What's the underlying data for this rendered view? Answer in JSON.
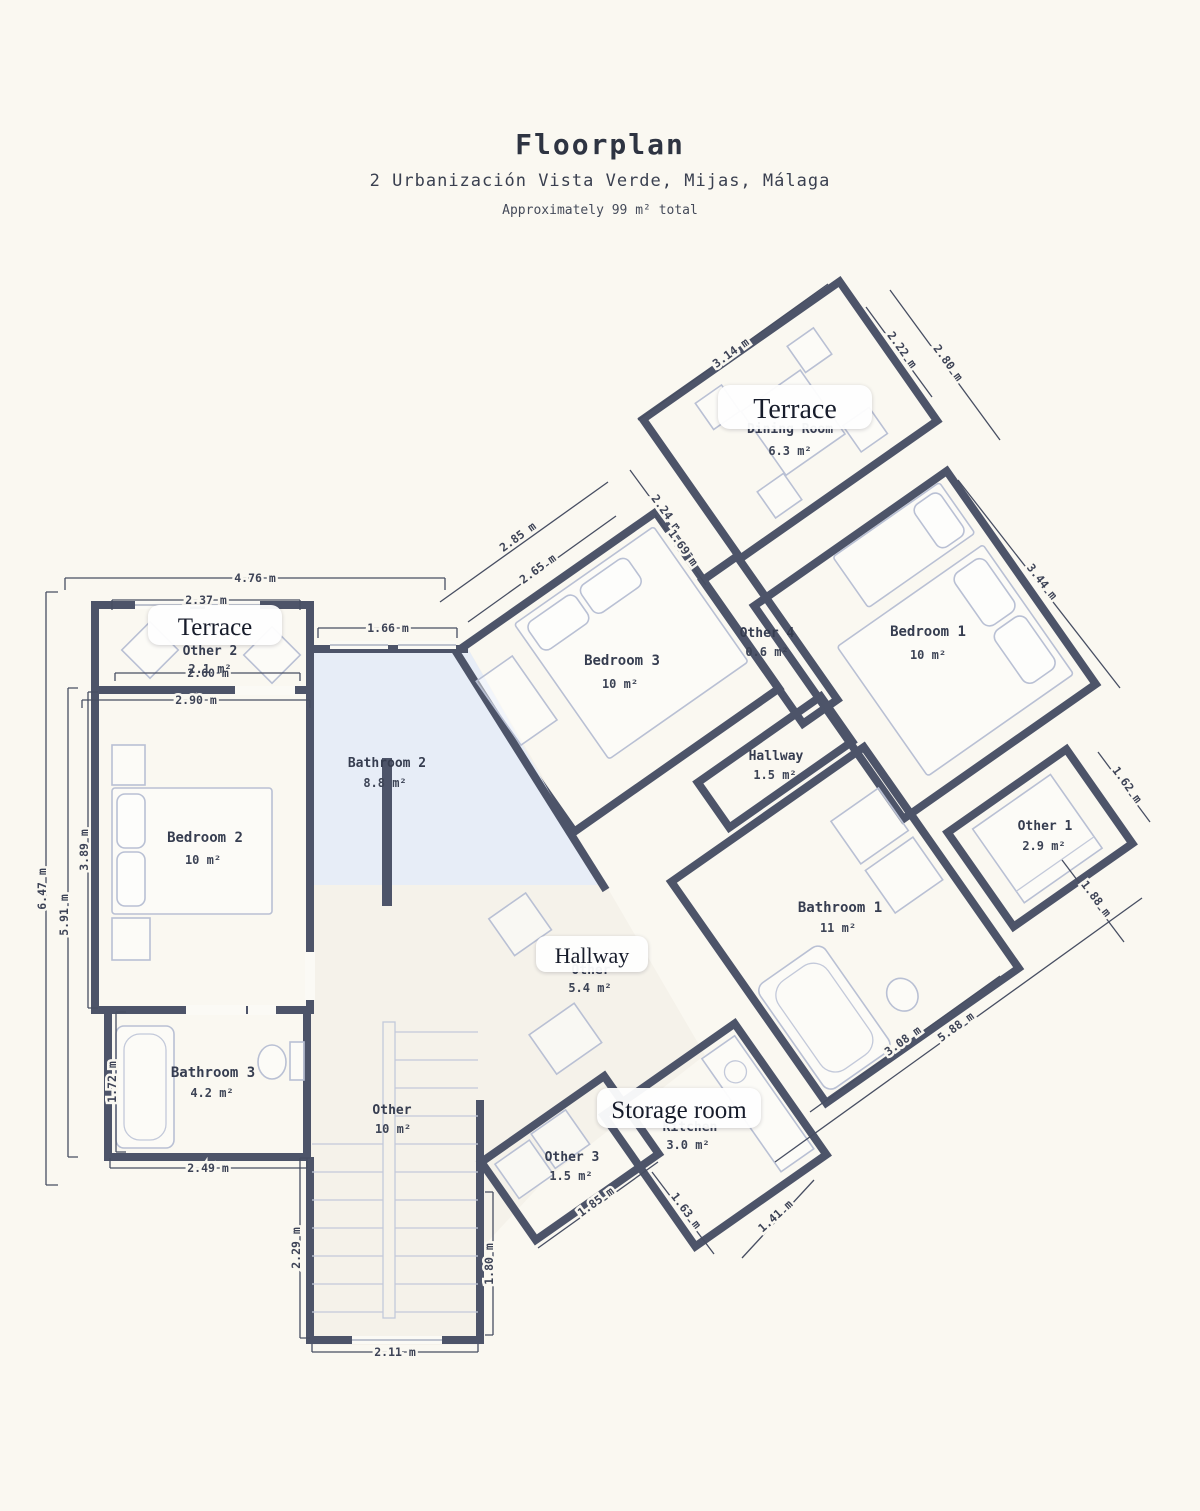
{
  "header": {
    "title": "Floorplan",
    "address": "2 Urbanización Vista Verde, Mijas, Málaga",
    "total_note": "Approximately 99 m² total"
  },
  "rooms": [
    {
      "name": "Dining Room",
      "area": "6.3 m²"
    },
    {
      "name": "Bedroom 1",
      "area": "10 m²"
    },
    {
      "name": "Bedroom 3",
      "area": "10 m²"
    },
    {
      "name": "Other 4",
      "area": "0.6 m²"
    },
    {
      "name": "Hallway",
      "area": "1.5 m²"
    },
    {
      "name": "Other 1",
      "area": "2.9 m²"
    },
    {
      "name": "Bathroom 1",
      "area": "11 m²"
    },
    {
      "name": "Bedroom 2",
      "area": "10 m²"
    },
    {
      "name": "Bathroom 2",
      "area": "8.8 m²"
    },
    {
      "name": "Other 2",
      "area": "2.1 m²"
    },
    {
      "name": "Other",
      "area": "5.4 m²"
    },
    {
      "name": "Bathroom 3",
      "area": "4.2 m²"
    },
    {
      "name": "Other",
      "area": "10 m²"
    },
    {
      "name": "Other 3",
      "area": "1.5 m²"
    },
    {
      "name": "Kitchen",
      "area": "3.0 m²"
    }
  ],
  "overlays": [
    {
      "text": "Terrace"
    },
    {
      "text": "Terrace"
    },
    {
      "text": "Hallway"
    },
    {
      "text": "Storage room"
    }
  ],
  "dimensions": [
    "4.76 m",
    "2.37 m",
    "1.66 m",
    "2.60 m",
    "2.90 m",
    "6.47 m",
    "5.91 m",
    "3.89 m",
    "1.72 m",
    "2.49 m",
    "2.29 m",
    "2.11 m",
    "1.80 m",
    "3.14 m",
    "2.22 m",
    "2.80 m",
    "2.24 m",
    "1.69 m",
    "2.85 m",
    "2.65 m",
    "3.44 m",
    "1.62 m",
    "1.88 m",
    "5.88 m",
    "3.08 m",
    "1.85 m",
    "1.63 m",
    "1.41 m"
  ],
  "colors": {
    "background": "#faf8f1",
    "wall": "#4d5469",
    "bedroom": "#e8edf7",
    "bathroom": "#e7edf7",
    "terrace": "#ddd1c0",
    "hallway_green": "#e3efe6",
    "kitchen": "#e6e6f2",
    "other": "#f5f2ea",
    "dimension": "#474e62",
    "label": "#363d50"
  }
}
